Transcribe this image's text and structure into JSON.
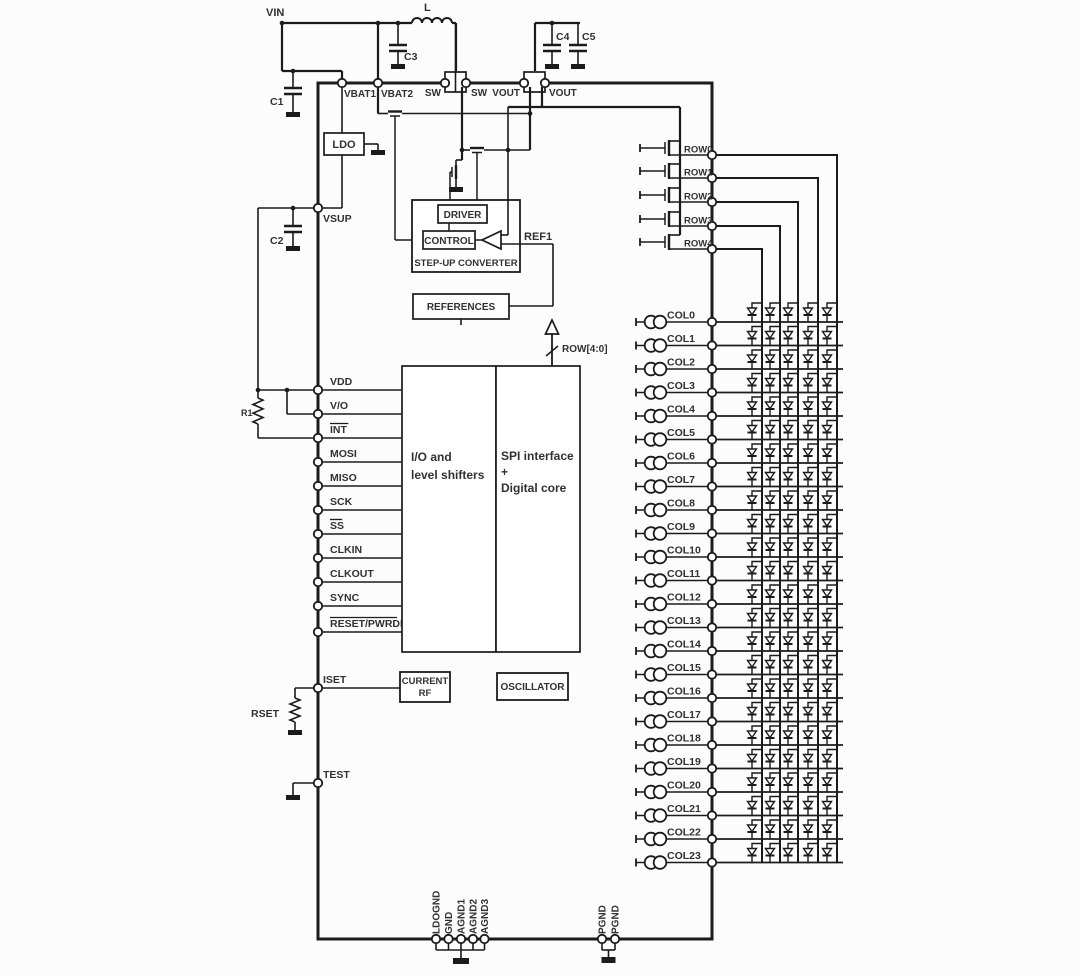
{
  "chip": {
    "top_pins": [
      "VBAT1",
      "VBAT2",
      "SW",
      "SW",
      "VOUT",
      "VOUT"
    ],
    "left_pins": [
      {
        "label": "VSUP",
        "overline": false
      },
      {
        "label": "VDD",
        "overline": false
      },
      {
        "label": "V/O",
        "overline": false
      },
      {
        "label": "INT",
        "overline": true
      },
      {
        "label": "MOSI",
        "overline": false
      },
      {
        "label": "MISO",
        "overline": false
      },
      {
        "label": "SCK",
        "overline": false
      },
      {
        "label": "SS",
        "overline": true
      },
      {
        "label": "CLKIN",
        "overline": false
      },
      {
        "label": "CLKOUT",
        "overline": false
      },
      {
        "label": "SYNC",
        "overline": false
      },
      {
        "label": "RESET/PWRDN",
        "overline": true
      },
      {
        "label": "ISET",
        "overline": false
      },
      {
        "label": "TEST",
        "overline": false
      }
    ],
    "row_pins": [
      "ROW0",
      "ROW1",
      "ROW2",
      "ROW3",
      "ROW4"
    ],
    "col_pins": [
      "COL0",
      "COL1",
      "COL2",
      "COL3",
      "COL4",
      "COL5",
      "COL6",
      "COL7",
      "COL8",
      "COL9",
      "COL10",
      "COL11",
      "COL12",
      "COL13",
      "COL14",
      "COL15",
      "COL16",
      "COL17",
      "COL18",
      "COL19",
      "COL20",
      "COL21",
      "COL22",
      "COL23"
    ],
    "bottom_pins": [
      "LDOGND",
      "GND",
      "AGND1",
      "AGND2",
      "AGND3",
      "PGND",
      "PGND"
    ],
    "blocks": {
      "ldo": "LDO",
      "driver": "DRIVER",
      "control": "CONTROL",
      "stepup": "STEP-UP CONVERTER",
      "references": "REFERENCES",
      "io_lines": [
        "I/O and",
        "level shifters"
      ],
      "spi_lines": [
        "SPI interface",
        "+",
        "Digital core"
      ],
      "current_ref_lines": [
        "CURRENT",
        "RF"
      ],
      "oscillator": "OSCILLATOR"
    },
    "nets": {
      "ref1": "REF1",
      "row_bus": "ROW[4:0]"
    }
  },
  "external_components": {
    "vin": "VIN",
    "inductor": "L",
    "c1": "C1",
    "c2": "C2",
    "c3": "C3",
    "c4": "C4",
    "c5": "C5",
    "r1": "R1",
    "rset": "RSET"
  },
  "colors": {
    "line": "#1b1b1b",
    "text": "#313131",
    "background": "#fcfcfc"
  }
}
